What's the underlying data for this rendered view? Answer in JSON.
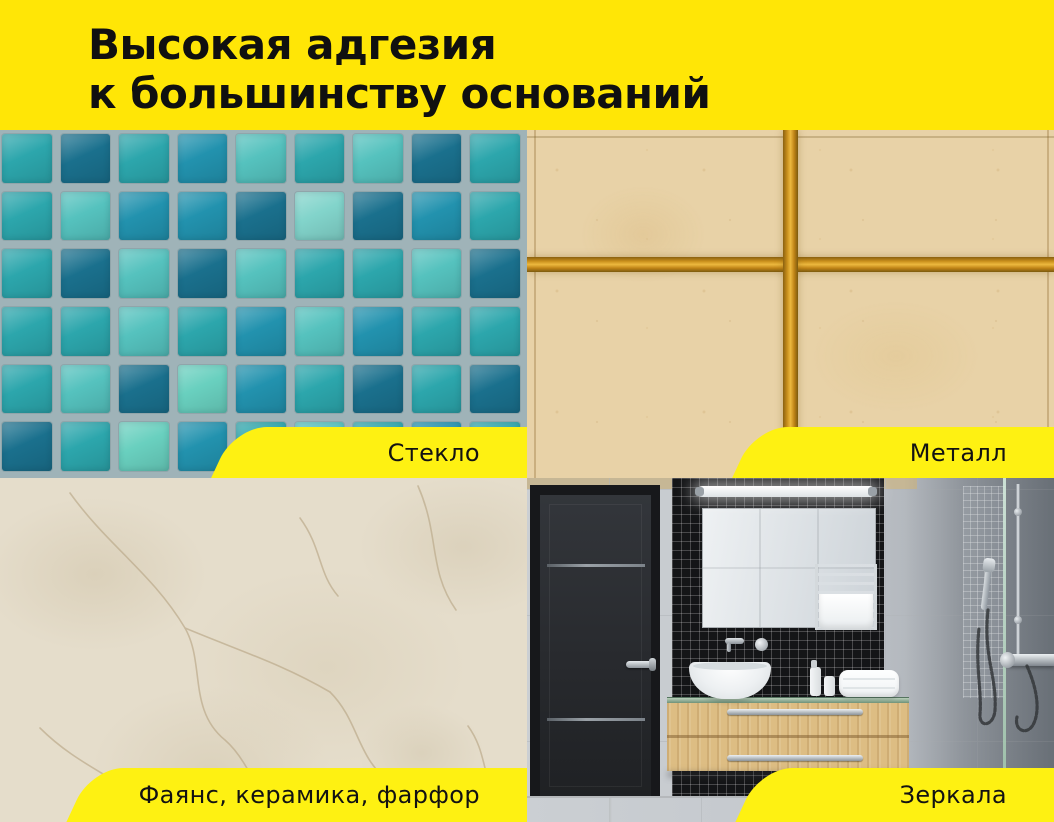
{
  "header": {
    "line1": "Высокая адгезия",
    "line2": "к большинству оснований"
  },
  "panels": [
    {
      "id": "glass",
      "label": "Стекло",
      "photo": "glass-mosaic-tiles"
    },
    {
      "id": "metal",
      "label": "Металл",
      "photo": "beige-tiles-gold-metal-grout"
    },
    {
      "id": "ceramic",
      "label": "Фаянс, керамика, фарфор",
      "photo": "beige-ceramic-marble-surface"
    },
    {
      "id": "mirrors",
      "label": "Зеркала",
      "photo": "bathroom-with-mirror-and-shower"
    }
  ],
  "colors": {
    "brand_yellow": "#FFE606",
    "banner_yellow": "#FEF112",
    "text_black": "#101010",
    "mosaic_grout": "#9FB3B8",
    "gold_grout": "#C8921F",
    "beige_tile": "#E8D2A7",
    "marble_beige": "#E5DDCB",
    "wall_gray": "#C7CBCF",
    "door_charcoal": "#2A2D31",
    "vanity_wood": "#DCBC82"
  },
  "glass_mosaic": {
    "grout": "#9FB3B8",
    "palette": {
      "T": "#2CA6AC",
      "D": "#1A708D",
      "L": "#55C2BE",
      "B": "#2292AE",
      "M": "#69D0BF",
      "P": "#82D4CB"
    },
    "pattern": [
      "TDTBLTLDT",
      "TLBBDPDBT",
      "TDLDLTTLD",
      "TTLTBLBTT",
      "TLDMBTDTD",
      "DTMBTLTBT"
    ]
  }
}
